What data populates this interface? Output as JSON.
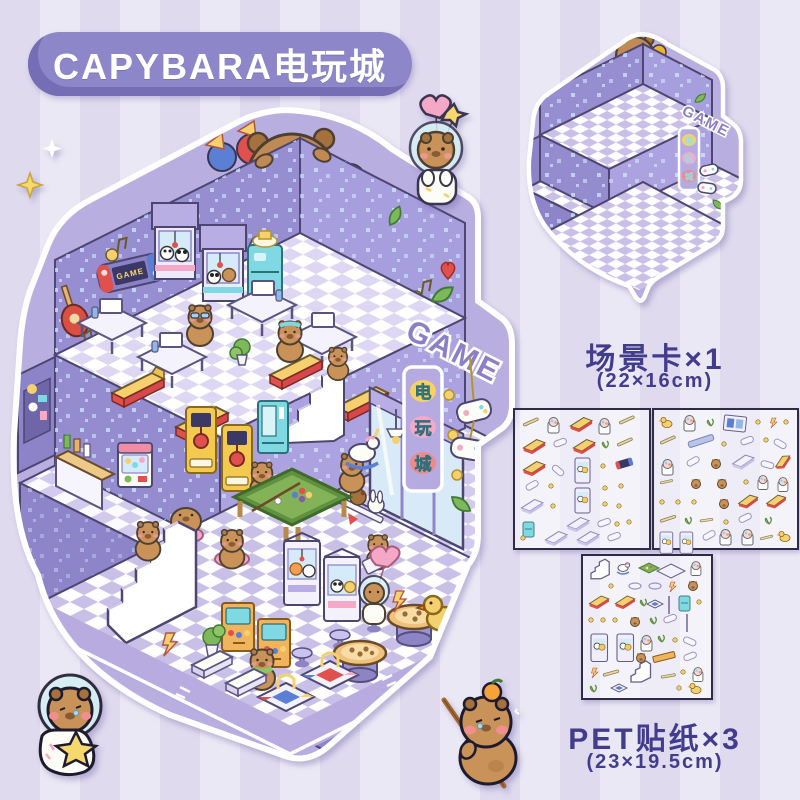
{
  "header": {
    "title": "CAPYBARA电玩城"
  },
  "product_illustration": {
    "name": "capybara-arcade-diorama",
    "signs": {
      "game_marquee": "GAME",
      "hall_name_chars": [
        "电",
        "玩",
        "城"
      ],
      "neon_line1": "GAME",
      "neon_line2": "START",
      "console_label": "GAME"
    }
  },
  "scene_card": {
    "caption": "场景卡×1",
    "size": "(22×16cm)",
    "sign": "GAME",
    "hall_name_chars": [
      "电",
      "玩",
      "城"
    ]
  },
  "sticker_sheets": {
    "caption": "PET贴纸×3",
    "size": "(23×19.5cm)"
  },
  "colors": {
    "caption_text": "#423c8c",
    "pill": "#8d86c8",
    "wall": "#978ed2",
    "wall_light": "#a79ede",
    "floor_tile": "#d6cfef",
    "accent_yellow": "#f6cf6e",
    "accent_red": "#e0514e",
    "accent_pink": "#f4a9c6",
    "accent_teal": "#7fd9e2",
    "pool_green": "#83b257",
    "capy_fur": "#c89258",
    "outline": "#4d4670"
  }
}
